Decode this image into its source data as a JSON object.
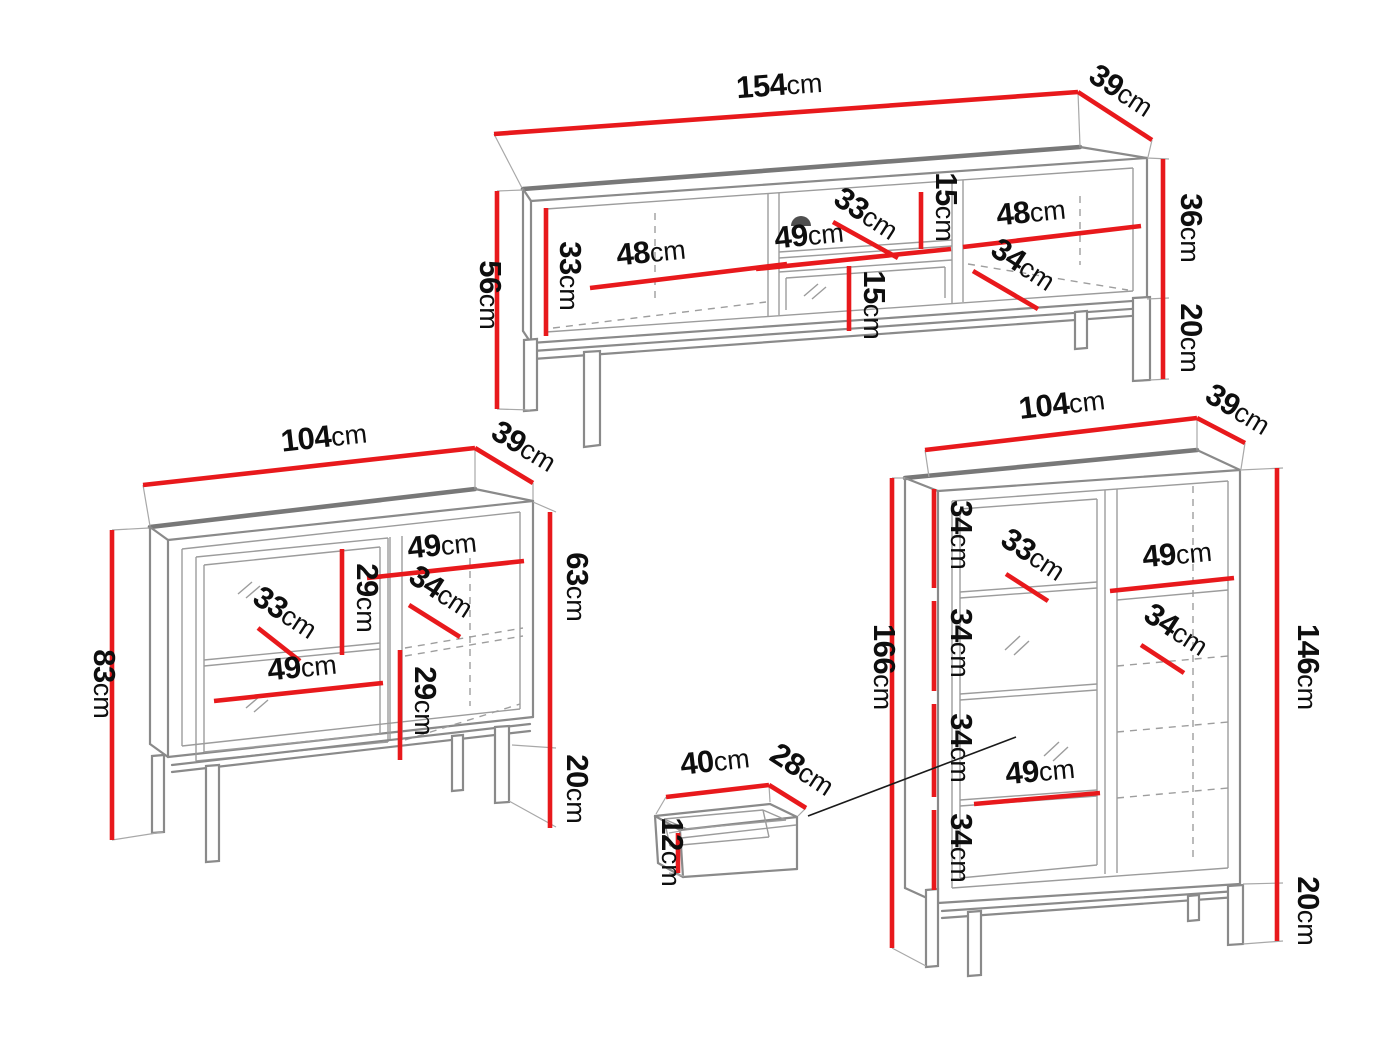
{
  "unit": "cm",
  "colors": {
    "dimension": "#e8191c",
    "outline": "#8a8a8a",
    "text": "#0e0e0e"
  },
  "pieces": {
    "tv_stand": {
      "name": "tv-stand",
      "width": "154",
      "depth": "39",
      "total_height": "56",
      "body_height": "36",
      "leg_height": "20",
      "left_compartment_width": "48",
      "left_compartment_height": "33",
      "middle_width": "49",
      "middle_depth": "33",
      "middle_top_shelf_height": "15",
      "middle_bottom_shelf_height": "15",
      "right_compartment_width": "48",
      "right_compartment_depth": "34"
    },
    "sideboard": {
      "name": "sideboard",
      "width": "104",
      "depth": "39",
      "total_height": "83",
      "body_height": "63",
      "leg_height": "20",
      "left_shelf_spacing": "29",
      "left_depth": "33",
      "left_width": "49",
      "right_width": "49",
      "right_depth": "34",
      "right_shelf_spacing": "29"
    },
    "cabinet": {
      "name": "display-cabinet",
      "width": "104",
      "depth": "39",
      "total_height": "166",
      "body_height": "146",
      "leg_height": "20",
      "shelf_spacings": [
        "34",
        "34",
        "34",
        "34"
      ],
      "left_depth": "33",
      "left_width": "49",
      "right_width": "49",
      "right_depth": "34"
    },
    "drawer": {
      "name": "drawer",
      "width": "40",
      "depth": "28",
      "height": "12"
    }
  }
}
